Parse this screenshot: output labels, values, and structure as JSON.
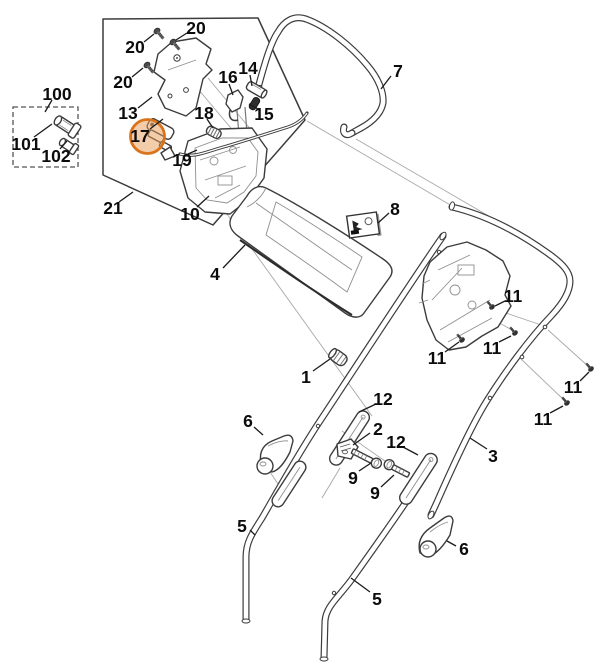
{
  "canvas": {
    "width": 602,
    "height": 672,
    "background": "#ffffff"
  },
  "diagram": {
    "type": "exploded-parts-diagram",
    "subject": "lawn mower handle assembly parts diagram",
    "line_color": "#3c3c3c",
    "thin_line_color": "#a8a8a8",
    "label_color": "#0c0c0c",
    "part_numbers_visible": [
      "1",
      "2",
      "3",
      "4",
      "5",
      "6",
      "7",
      "8",
      "9",
      "10",
      "11",
      "12",
      "13",
      "14",
      "15",
      "16",
      "17",
      "18",
      "19",
      "20",
      "21",
      "100",
      "101",
      "102"
    ],
    "highlight": {
      "encircled_part": "17",
      "stroke": "#d9731c",
      "fill": "#e89a55"
    },
    "labels": [
      {
        "text": "20"
      },
      {
        "text": "20"
      },
      {
        "text": "20"
      },
      {
        "text": "13"
      },
      {
        "text": "17"
      },
      {
        "text": "18"
      },
      {
        "text": "19"
      },
      {
        "text": "16"
      },
      {
        "text": "14"
      },
      {
        "text": "15"
      },
      {
        "text": "10"
      },
      {
        "text": "21"
      },
      {
        "text": "100"
      },
      {
        "text": "101"
      },
      {
        "text": "102"
      },
      {
        "text": "7"
      },
      {
        "text": "8"
      },
      {
        "text": "4"
      },
      {
        "text": "1"
      },
      {
        "text": "11"
      },
      {
        "text": "11"
      },
      {
        "text": "11"
      },
      {
        "text": "11"
      },
      {
        "text": "11"
      },
      {
        "text": "3"
      },
      {
        "text": "12"
      },
      {
        "text": "2"
      },
      {
        "text": "12"
      },
      {
        "text": "9"
      },
      {
        "text": "9"
      },
      {
        "text": "6"
      },
      {
        "text": "6"
      },
      {
        "text": "5"
      },
      {
        "text": "5"
      }
    ]
  }
}
